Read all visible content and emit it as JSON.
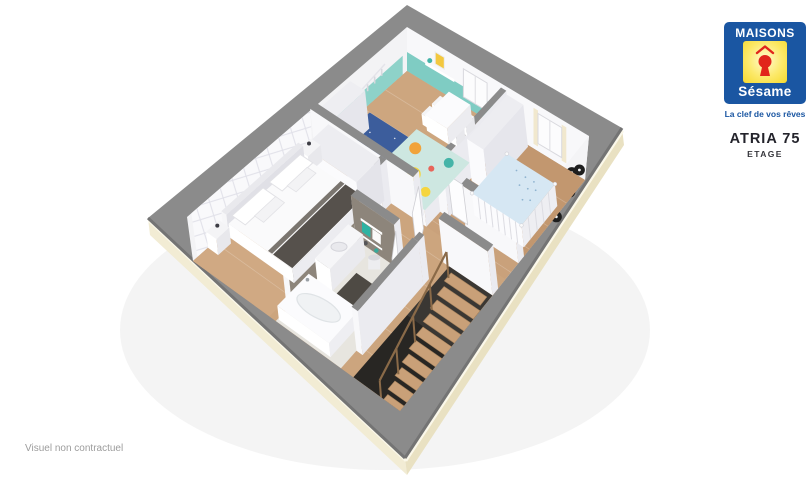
{
  "branding": {
    "brand_top": "MAISONS",
    "brand_bottom": "Sésame",
    "tagline": "La clef de vos rêves"
  },
  "plan_info": {
    "model_name": "ATRIA 75",
    "floor_label": "ETAGE"
  },
  "footer": {
    "disclaimer": "Visuel non contractuel"
  },
  "colors": {
    "wall_top": "#8b8b8b",
    "wall_rim": "#747474",
    "wall_face": "#f8f8fa",
    "wall_face_shade": "#ebebf0",
    "facade_cream": "#f2ecd4",
    "facade_cream_dark": "#e9e1c2",
    "facade_highlight": "#fbf8ea",
    "wood": "#c9a17b",
    "wood_bed": "#d0a983",
    "wood_kids": "#cda67f",
    "wood_nursery": "#c2976f",
    "wood_hall": "#cca57e",
    "bath_floor": "#e7e5df",
    "bath_wall": "#8d857b",
    "teal_wall": "#7fccc3",
    "teal_dark": "#45b4a8",
    "rug_blue": "#3c5d9c",
    "play_mat": "#cde7e1",
    "toy_orange": "#f1a33b",
    "toy_yellow": "#f5d53e",
    "toy_red": "#ef7f4e",
    "stair_wood": "#c9a078",
    "stairwell": "#3a3733",
    "runner_dark": "#56514c",
    "record_black": "#1e1e1e",
    "logo_blue": "#1a56a2",
    "logo_red": "#e1251b",
    "title_color": "#23232b",
    "floor_label_color": "#35353b",
    "disclaimer_gray": "#9c9c9c"
  }
}
